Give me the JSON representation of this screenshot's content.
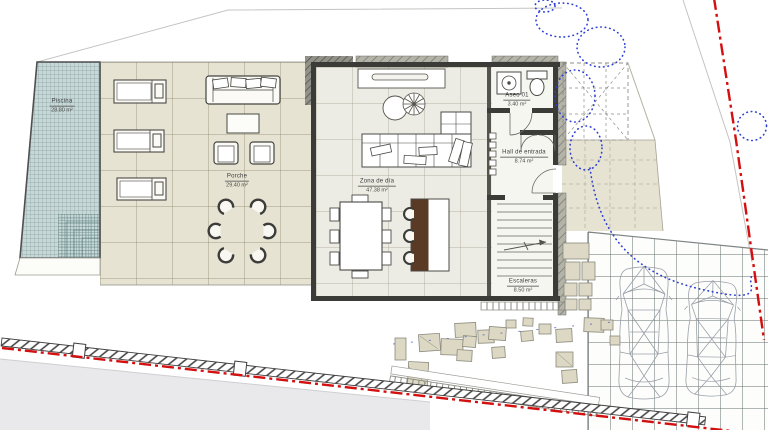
{
  "title": "Planta baja - plano de situación",
  "rooms": {
    "piscina": {
      "name": "Piscina",
      "area": "28.80 m²"
    },
    "porche": {
      "name": "Porche",
      "area": "29.40 m²"
    },
    "zona_dia": {
      "name": "Zona de día",
      "area": "47.38 m²"
    },
    "aseo": {
      "name": "Aseo 01",
      "area": "3.40 m²"
    },
    "hall": {
      "name": "Hall de entrada",
      "area": "8.74 m²"
    },
    "escaleras": {
      "name": "Escaleras",
      "area": "8.50 m²"
    }
  },
  "colors": {
    "boundary_red": "#d40f0f",
    "vegetation_blue": "#2b3fd4",
    "pool_water": "#c8d8d8",
    "island_wood": "#5b3a25",
    "paving_beige": "#e6e3d3",
    "wall_dark": "#3b3b37"
  }
}
